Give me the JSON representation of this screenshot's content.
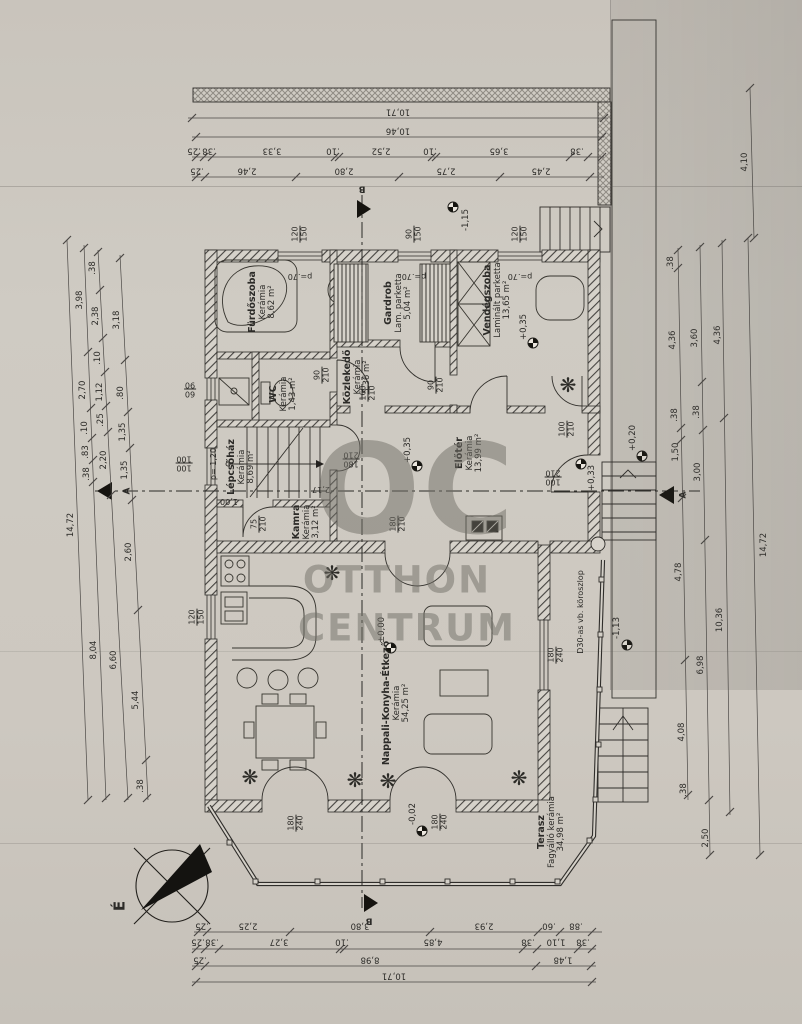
{
  "watermark": {
    "oc": "OC",
    "line1": "OTTHON",
    "line2": "CENTRUM"
  },
  "compass": {
    "north": "É"
  },
  "sections": {
    "a": "A",
    "b": "B"
  },
  "parapet": "p=.70",
  "notes": {
    "column": "D30-as vb. köroszlop",
    "stair_parapet": "p= 1,20",
    "stair_run": "2,17",
    "stair_width": "1,00"
  },
  "levels": {
    "upper": "-1,15",
    "guest": "+0,35",
    "hall": "+0,35",
    "entry": "+0,33",
    "living": "±0,00",
    "terrace": "-0,02",
    "steps": "+0,20",
    "garden": "-1,13"
  },
  "rooms": [
    {
      "name": "Fürdőszoba",
      "material": "Kerámia",
      "area": "8,62 m²"
    },
    {
      "name": "WC",
      "material": "Kerámia",
      "area": "1,43 m²"
    },
    {
      "name": "Közlekedő",
      "material": "Kerámia",
      "area": "5,36 m²"
    },
    {
      "name": "Gardrob",
      "material": "Lam. parketta",
      "area": "5,04 m²"
    },
    {
      "name": "Vendégszoba",
      "material": "Laminált parketta",
      "area": "13,65 m²"
    },
    {
      "name": "Lépcsőház",
      "material": "Kerámia",
      "area": "8,69 m²"
    },
    {
      "name": "Kamra",
      "material": "Kerámia",
      "area": "3,12 m²"
    },
    {
      "name": "Előtér",
      "material": "Kerámia",
      "area": "13,99 m²"
    },
    {
      "name": "Nappali-Konyha-Étkező",
      "material": "Kerámia",
      "area": "54,25 m²"
    },
    {
      "name": "Terasz",
      "material": "Fagyálló kerámia",
      "area": "34,98 m²"
    }
  ],
  "openings": [
    {
      "w": "120",
      "h": "150"
    },
    {
      "w": "90",
      "h": "150"
    },
    {
      "w": "120",
      "h": "150"
    },
    {
      "w": "60",
      "h": "90"
    },
    {
      "w": "100",
      "h": "100"
    },
    {
      "w": "120",
      "h": "150"
    },
    {
      "w": "90",
      "h": "210"
    },
    {
      "w": "160",
      "h": "210"
    },
    {
      "w": "90",
      "h": "210"
    },
    {
      "w": "100",
      "h": "210"
    },
    {
      "w": "100",
      "h": "210"
    },
    {
      "w": "75",
      "h": "210"
    },
    {
      "w": "180",
      "h": "210"
    },
    {
      "w": "180",
      "h": "210"
    },
    {
      "w": "180",
      "h": "240"
    },
    {
      "w": "180",
      "h": "240"
    },
    {
      "w": "180",
      "h": "240"
    }
  ],
  "dims": {
    "top": [
      [
        "10,71"
      ],
      [
        "10,46"
      ],
      [
        ".25",
        ".38",
        "3,33",
        ".10",
        "2,52",
        ".10",
        "3,65",
        ".38"
      ],
      [
        ".25",
        "2,46",
        "2,80",
        "2,75",
        "2,45"
      ]
    ],
    "bottom": [
      [
        ".25",
        "2,25",
        "3,80",
        "2,93",
        ".60",
        ".88"
      ],
      [
        ".25",
        ".38",
        "3,27",
        ".10",
        "4,85",
        ".38",
        "1,10",
        ".38"
      ],
      [
        ".25",
        "8,98",
        "1,48"
      ],
      [
        "10,71"
      ]
    ],
    "left": [
      [
        "14,72"
      ],
      [
        "3,98",
        "2,70",
        ".10",
        ".83",
        ".38",
        "8,04"
      ],
      [
        ".38",
        "2,38",
        ".10",
        "1,12",
        ".25",
        "2,20",
        "6,60"
      ],
      [
        "3,18",
        ".80",
        "1,35",
        "1,35",
        "2,60",
        "5,44",
        ".38"
      ]
    ],
    "right": [
      [
        "14,72"
      ],
      [
        "4,36",
        "10,36"
      ],
      [
        "3,60",
        ".38",
        "3,00",
        "6,98",
        "2,50"
      ],
      [
        ".38",
        "4,36",
        ".38",
        "1,50",
        "4,78",
        "4,08",
        ".38"
      ]
    ],
    "right_top": "4,10"
  }
}
